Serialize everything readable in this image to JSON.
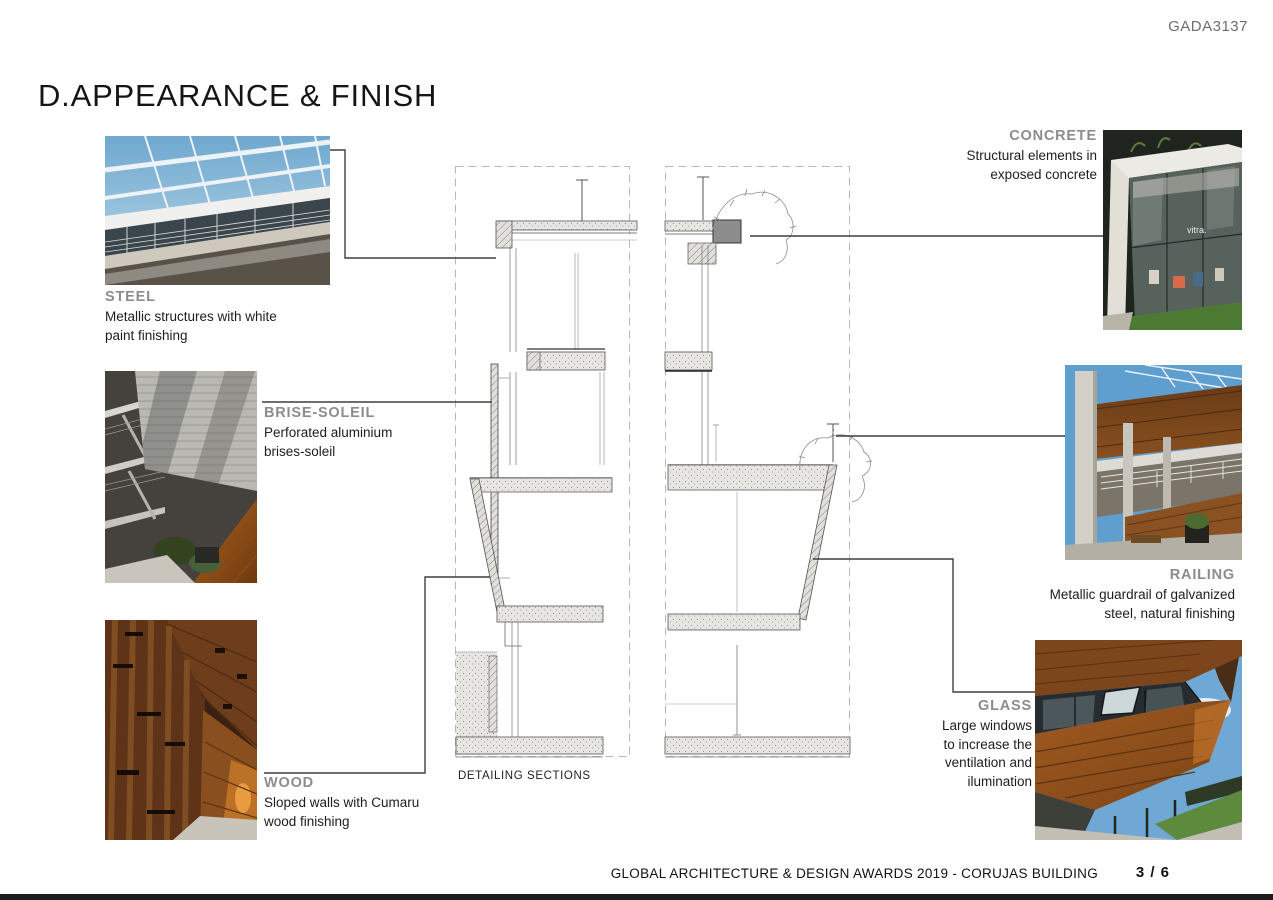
{
  "page": {
    "code": "GADA3137",
    "title": "D.APPEARANCE & FINISH",
    "drawing_caption": "DETAILING SECTIONS",
    "footer_text": "GLOBAL ARCHITECTURE & DESIGN AWARDS 2019 - CORUJAS BUILDING",
    "page_number": "3 / 6"
  },
  "materials": {
    "steel": {
      "name": "STEEL",
      "description": "Metallic structures with white paint finishing"
    },
    "brise_soleil": {
      "name": "BRISE-SOLEIL",
      "description": "Perforated aluminium brises-soleil"
    },
    "wood": {
      "name": "WOOD",
      "description": "Sloped walls with Cumaru wood finishing"
    },
    "concrete": {
      "name": "CONCRETE",
      "description": "Structural elements in exposed concrete"
    },
    "railing": {
      "name": "RAILING",
      "description": "Metallic guardrail of galvanized steel, natural finishing"
    },
    "glass": {
      "name": "GLASS",
      "description": "Large windows to increase the ventilation and ilumination"
    }
  },
  "photos": {
    "concrete_overlay_text": "vitra."
  },
  "colors": {
    "accent_label": "#8c8c8c",
    "body_text": "#1d1d1d",
    "callout_line": "#3f3f3f"
  }
}
